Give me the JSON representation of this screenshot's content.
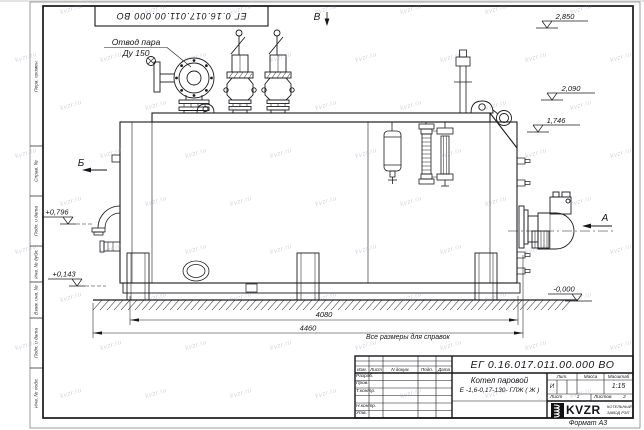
{
  "sheet": {
    "stamp_top": "ЕГ 0.16.017.011.00.000  ВО",
    "reference_note": "Все размеры для справок",
    "format_label": "Формат А3",
    "watermark_text": "kvzr.ru"
  },
  "frame": {
    "left_labels": [
      "Перв. примен.",
      "Справ. №",
      "Подп. и дата",
      "Инв. № дубл.",
      "Взам. инв. №",
      "Подп. и дата",
      "Инв. № подл."
    ]
  },
  "title_block": {
    "doc_number": "ЕГ 0.16.017.011.00.000  ВО",
    "product_name": "Котел паровой",
    "product_model": "Е -1,6-0,17-130- ГЛЖ ( Ж )",
    "header_cols": [
      "Изм.",
      "Лист",
      "N докум.",
      "Подп.",
      "Дата"
    ],
    "row_labels": [
      "Разраб.",
      "Пров.",
      "Т.контр.",
      "",
      "Н.контр.",
      "Утв."
    ],
    "lit_label": "Лит.",
    "lit_value": "И",
    "mass_label": "Масса",
    "mass_value": "",
    "scale_label": "Масштаб",
    "scale_value": "1:15",
    "sheet_word": "Лист",
    "sheet_num": "1",
    "sheets_word": "Листов",
    "sheets_num": "2",
    "logo_text": "KVZR",
    "company_line1": "КОТЕЛЬНЫЙ",
    "company_line2": "ЗАВОД РЭП"
  },
  "drawing": {
    "labels": {
      "steam_outlet_1": "Отвод пара",
      "steam_outlet_2": "Ду 150",
      "view_a": "А",
      "view_b": "Б",
      "view_v": "В"
    },
    "dims": {
      "body": "4080",
      "overall": "4460"
    },
    "elevations": {
      "top": "2,850",
      "mid": "2,090",
      "low": "1,746",
      "left_up": "+0,796",
      "left_dn": "+0,143",
      "ground": "-0,000"
    }
  }
}
